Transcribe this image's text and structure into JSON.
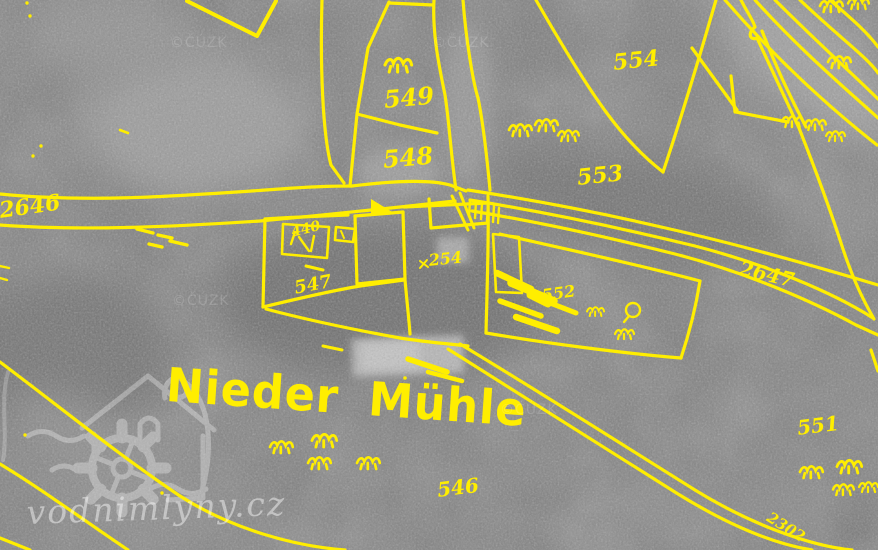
{
  "map": {
    "place_label": "Nieder Mühle",
    "parcel_labels": [
      {
        "id": "2646",
        "text": "2646"
      },
      {
        "id": "549",
        "text": "549"
      },
      {
        "id": "548",
        "text": "548"
      },
      {
        "id": "554",
        "text": "554"
      },
      {
        "id": "553",
        "text": "553"
      },
      {
        "id": "2647",
        "text": "2647"
      },
      {
        "id": "440",
        "text": "440"
      },
      {
        "id": "254",
        "text": "254"
      },
      {
        "id": "547",
        "text": "547"
      },
      {
        "id": "552",
        "text": "552"
      },
      {
        "id": "551",
        "text": "551"
      },
      {
        "id": "546",
        "text": "546"
      },
      {
        "id": "2302",
        "text": "2302"
      }
    ],
    "overlay_color": "#ffee00",
    "photo_tone": "#7e7e7e",
    "symbol_names": [
      "grass-tuft-icon",
      "tree-icon",
      "bridge-hatch",
      "building-outline",
      "boundary-line"
    ]
  },
  "watermark": {
    "site": "vodnimlyny.cz",
    "logo": "watermill-logo",
    "copyright": "©ČÚZK"
  }
}
